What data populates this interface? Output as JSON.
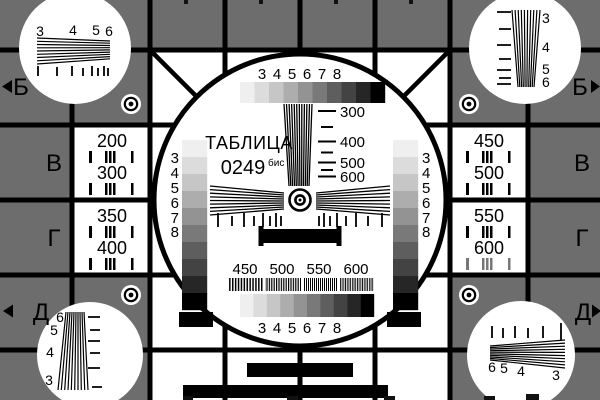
{
  "colors": {
    "background": "#6d6d6d",
    "ink": "#000000",
    "paper": "#ffffff",
    "grayscale": [
      "#efefef",
      "#dcdcdc",
      "#c6c6c6",
      "#adadad",
      "#939393",
      "#797979",
      "#5e5e5e",
      "#434343",
      "#262626",
      "#000000"
    ]
  },
  "title": {
    "line1": "ТАБЛИЦА",
    "number": "0249",
    "suffix": "бис"
  },
  "row_markers": {
    "left": [
      "Б",
      "В",
      "Г",
      "Д"
    ],
    "right": [
      "Б",
      "В",
      "Г",
      "Д"
    ]
  },
  "scales": {
    "top": [
      "3",
      "4",
      "5",
      "6",
      "7",
      "8"
    ],
    "bottom": [
      "3",
      "4",
      "5",
      "6",
      "7",
      "8"
    ]
  },
  "frequencies": {
    "center_vertical": [
      "300",
      "400",
      "500",
      "600"
    ],
    "bottom": [
      "450",
      "500",
      "550",
      "600"
    ],
    "left_cells": [
      "200",
      "300",
      "350",
      "400"
    ],
    "right_cells": [
      "450",
      "500",
      "550",
      "600"
    ]
  },
  "gray_bar_labels": {
    "left": [
      "3",
      "4",
      "5",
      "6",
      "7",
      "8"
    ],
    "right": [
      "3",
      "4",
      "5",
      "6",
      "7",
      "8"
    ]
  },
  "corner_wedge_labels": {
    "top_left": [
      "3",
      "4",
      "5",
      "6"
    ],
    "top_right": [
      "3",
      "4",
      "5",
      "6"
    ],
    "bottom_left": [
      "6",
      "5",
      "4",
      "3"
    ],
    "bottom_right": [
      "6",
      "5",
      "4",
      "3"
    ]
  }
}
